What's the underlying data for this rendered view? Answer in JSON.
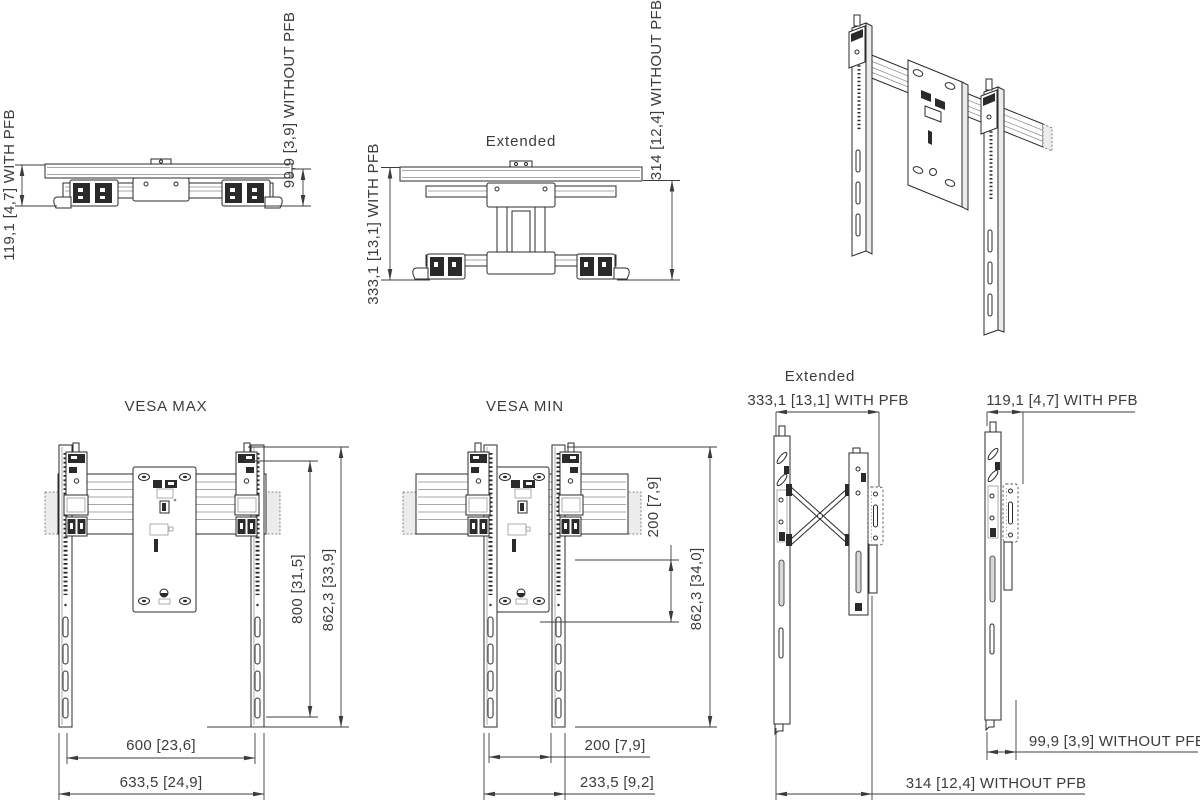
{
  "drawing": {
    "top_folded": {
      "dim_with_pfb": "119,1 [4,7]  WITH PFB",
      "dim_without_pfb": "99,9 [3,9]  WITHOUT PFB"
    },
    "top_extended": {
      "title": "Extended",
      "dim_with_pfb": "333,1 [13,1]  WITH PFB",
      "dim_without_pfb": "314 [12,4]  WITHOUT PFB"
    },
    "vesa_max": {
      "title": "VESA MAX",
      "dim_height_inner": "800 [31,5]",
      "dim_height_outer": "862,3 [33,9]",
      "dim_width_inner": "600 [23,6]",
      "dim_width_outer": "633,5 [24,9]"
    },
    "vesa_min": {
      "title": "VESA MIN",
      "dim_height_inner": "200 [7,9]",
      "dim_height_outer": "862,3 [34,0]",
      "dim_width_inner": "200 [7,9]",
      "dim_width_outer": "233,5 [9,2]"
    },
    "side_extended": {
      "title": "Extended",
      "dim_top": "333,1 [13,1]  WITH PFB",
      "dim_bottom": "314 [12,4]  WITHOUT PFB"
    },
    "side_folded": {
      "dim_top": "119,1 [4,7]  WITH PFB",
      "dim_bottom": "99,9 [3,9]  WITHOUT PFB"
    },
    "colors": {
      "line": "#2b2b2b",
      "text": "#3c3c3c",
      "background": "#ffffff"
    }
  }
}
